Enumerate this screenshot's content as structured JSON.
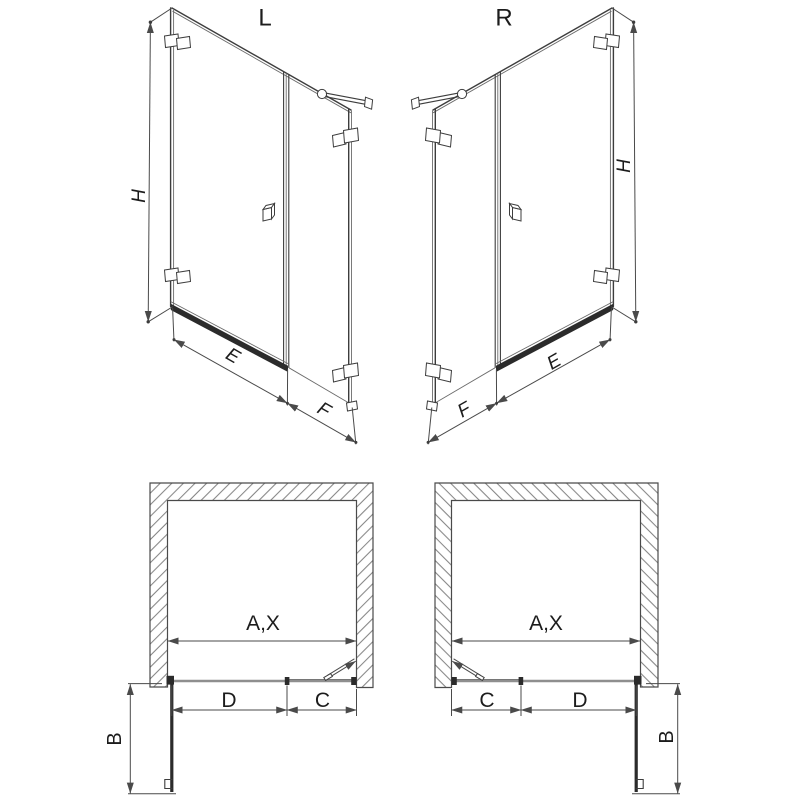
{
  "figure": {
    "views": {
      "front_left": {
        "title": "L",
        "height_label": "H",
        "door_width_label": "E",
        "side_panel_label": "F"
      },
      "front_right": {
        "title": "R",
        "height_label": "H",
        "door_width_label": "E",
        "side_panel_label": "F"
      },
      "plan_left": {
        "opening_label": "A,X",
        "door_label": "D",
        "fixed_label": "C",
        "depth_label": "B"
      },
      "plan_right": {
        "opening_label": "A,X",
        "door_label": "D",
        "fixed_label": "C",
        "depth_label": "B"
      }
    },
    "colors": {
      "background": "#ffffff",
      "line": "#3d3d3d",
      "line_light": "#6b6b6b",
      "dim_line": "#4a4a4a",
      "dark_profile": "#2b2b2b",
      "glass_gray": "#8f8f8f",
      "hatch": "#707070",
      "text": "#1c1c1c"
    }
  }
}
